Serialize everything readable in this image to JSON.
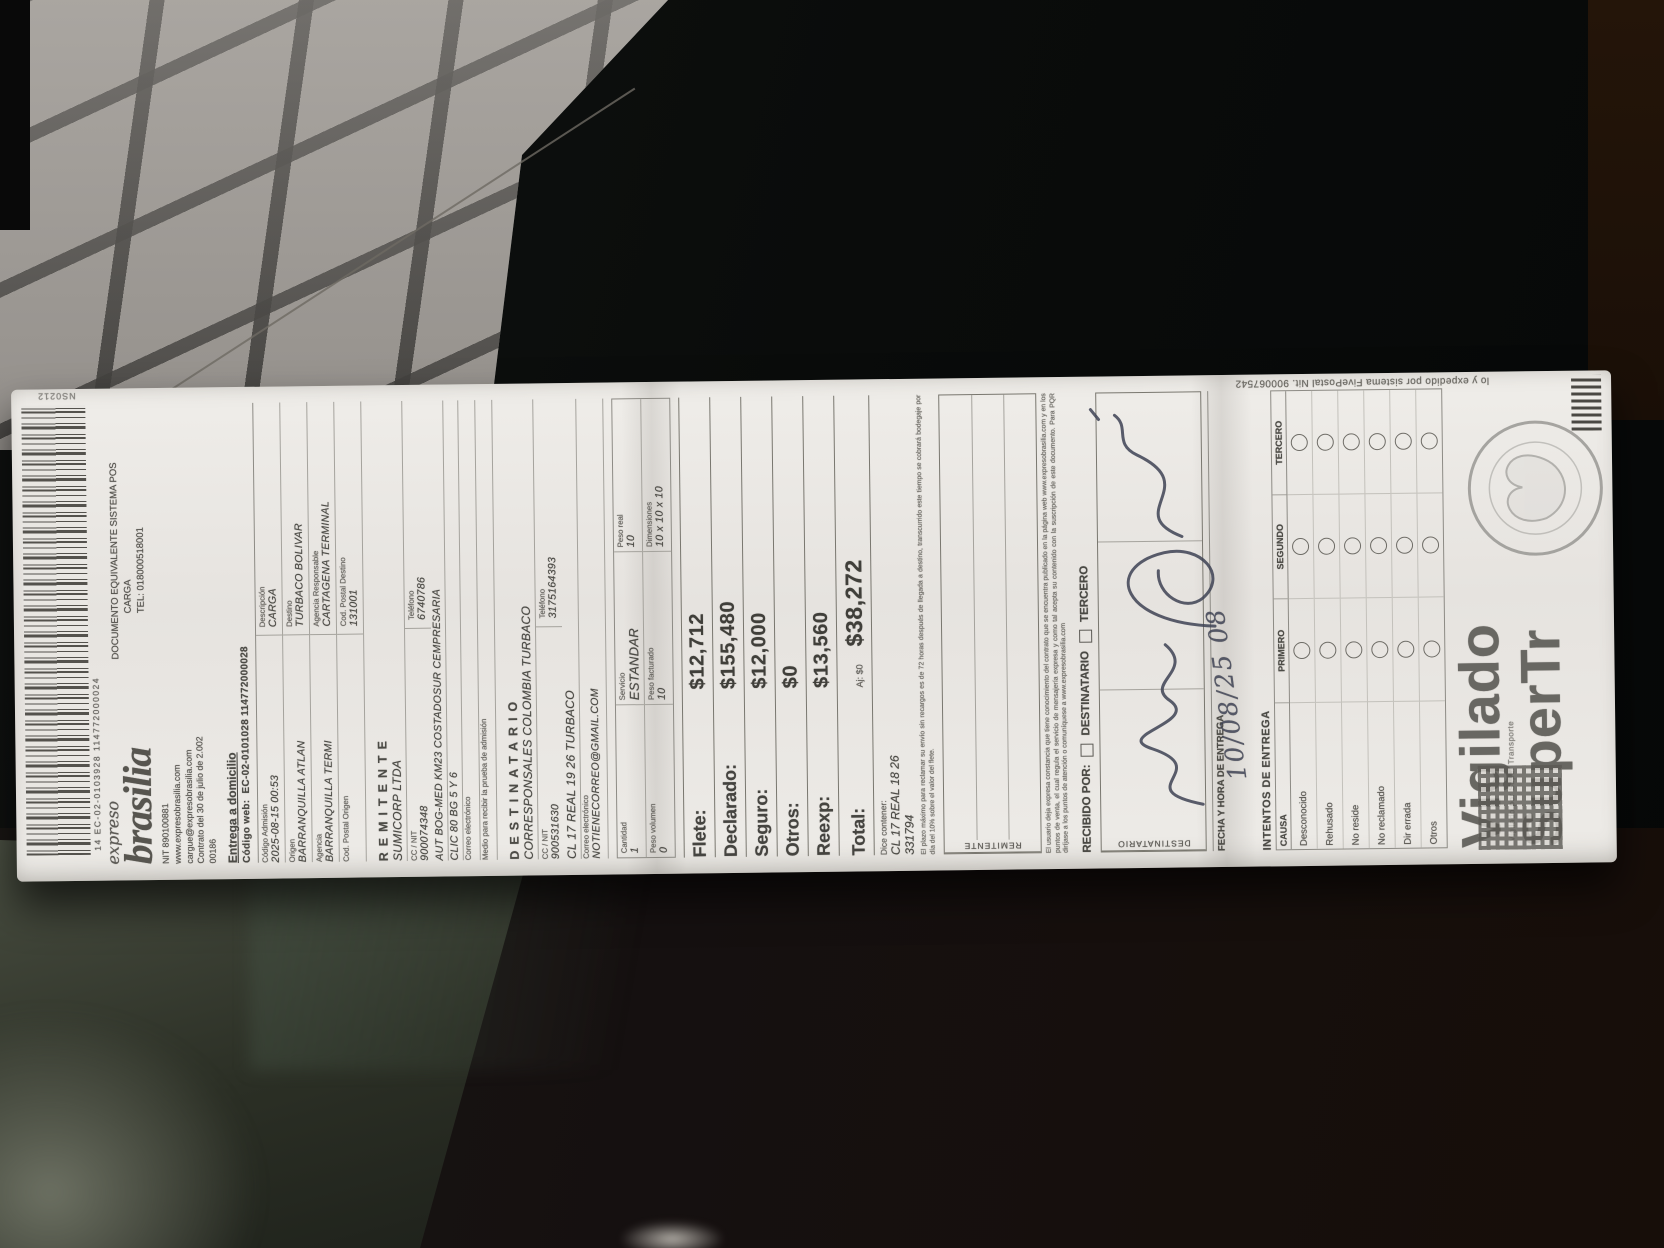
{
  "header": {
    "codigo_esquina": "NS0212",
    "barcode_numero": "14 EC-02-0103928 114772000024",
    "marca_script": "expreso",
    "marca": "brasilia",
    "documento": "DOCUMENTO EQUIVALENTE SISTEMA POS",
    "categoria": "CARGA",
    "telefono": "TEL: 018000518001",
    "nit": "NIT 890100881",
    "web": "www.expresobrasilia.com",
    "correo_carga": "cargue@expresobrasilia.com",
    "contrato": "Contrato del 30 de julio de 2.002",
    "codigo": "00186"
  },
  "entrega": {
    "titulo": "Entrega a domicilio",
    "codigo_web_label": "Código web:",
    "codigo_web": "EC-02-0101028 114772000028"
  },
  "admision": {
    "codigo_admision_label": "Código Admisión",
    "codigo_admision": "2025-08-15 00:53",
    "descripcion_label": "Descripción",
    "descripcion": "CARGA",
    "origen_label": "Origen",
    "origen": "BARRANQUILLA ATLAN",
    "destino_label": "Destino",
    "destino": "TURBACO BOLIVAR",
    "agencia_label": "Agencia",
    "agencia": "BARRANQUILLA TERMI",
    "agencia_resp_label": "Agencia Responsable",
    "agencia_resp": "CARTAGENA TERMINAL",
    "cod_postal_origen_label": "Cod. Postal Origen",
    "cod_postal_origen": "",
    "cod_postal_destino_label": "Cod. Postal Destino",
    "cod_postal_destino": "131001"
  },
  "remitente": {
    "titulo": "REMITENTE",
    "nombre": "SUMICORP LTDA",
    "cc_nit_label": "CC / NIT",
    "cc_nit": "900074348",
    "telefono_label": "Teléfono",
    "telefono": "6740786",
    "direccion1": "AUT BOG-MED KM23 COSTADOSUR CEMPRESARIA",
    "direccion2": "CLIC 80 BG 5 Y 6",
    "correo_label": "Correo electrónico",
    "correo": "",
    "medio_label": "Medio para recibir la prueba de admisión"
  },
  "destinatario": {
    "titulo": "DESTINATARIO",
    "nombre": "CORRESPONSALES COLOMBIA TURBACO",
    "cc_nit_label": "CC / NIT",
    "cc_nit": "900531630",
    "telefono_label": "Teléfono",
    "telefono": "3175164393",
    "direccion": "CL 17 REAL 19 26 TURBACO",
    "correo_label": "Correo electrónico",
    "correo": "NOTIENECORREO@GMAIL.COM"
  },
  "paquete": {
    "cantidad_label": "Cantidad",
    "cantidad": "1",
    "servicio_label": "Servicio",
    "servicio": "ESTANDAR",
    "peso_real_label": "Peso real",
    "peso_real": "10",
    "peso_volumen_label": "Peso volumen",
    "peso_volumen": "0",
    "peso_facturado_label": "Peso facturado",
    "peso_facturado": "10",
    "dimensiones_label": "Dimensiones",
    "dimensiones": "10 x 10 x 10"
  },
  "cargos": {
    "flete_label": "Flete:",
    "flete": "$12,712",
    "declarado_label": "Declarado:",
    "declarado": "$155,480",
    "seguro_label": "Seguro:",
    "seguro": "$12,000",
    "otros_label": "Otros:",
    "otros": "$0",
    "reexp_label": "Reexp:",
    "reexp": "$13,560",
    "ajuste": "Aj: $0",
    "total_label": "Total:",
    "total": "$38,272"
  },
  "contenido": {
    "dice_label": "Dice contener:",
    "dice": "CL 17 REAL 18 26",
    "referencia": "331794"
  },
  "legal": {
    "nota_envio": "El plazo máximo para reclamar su envío sin recargos es de 72 horas después de llegada a destino, transcurrido este tiempo se cobrará bodegaje por día del 10% sobre el valor del flete.",
    "contrato": "El usuario deja expresa constancia que tiene conocimiento del contrato que se encuentra publicado en la página web www.expresobrasilia.com y en los puntos de venta, el cual regula el servicio de mensajería expresa y como tal acepta su contenido con la suscripción de este documento. Para PQR diríjase a los puntos de atención o comuníquese a www.expresobrasilia.com",
    "fivepostal": "lo y expedido por sistema FivePostal Nit. 900067542"
  },
  "confirmacion": {
    "remitente_label": "REMITENTE",
    "destinatario_label": "DESTINATARIO",
    "recibido_por": "RECIBIDO POR:",
    "opcion_destinatario": "DESTINATARIO",
    "opcion_tercero": "TERCERO",
    "fecha_label": "FECHA Y HORA DE ENTREGA",
    "fecha_manuscrita": "10/08/25 08"
  },
  "intentos": {
    "titulo": "INTENTOS DE ENTREGA",
    "causa_label": "CAUSA",
    "columnas": [
      "PRIMERO",
      "SEGUNDO",
      "TERCERO"
    ],
    "causas": [
      "Desconocido",
      "Rehusado",
      "No reside",
      "No reclamado",
      "Dir errada",
      "Otros"
    ]
  },
  "vigilado": {
    "linea1": "Vigilado",
    "linea2": "SuperTr",
    "pequeno": "Vigilado por Super Transporte"
  }
}
